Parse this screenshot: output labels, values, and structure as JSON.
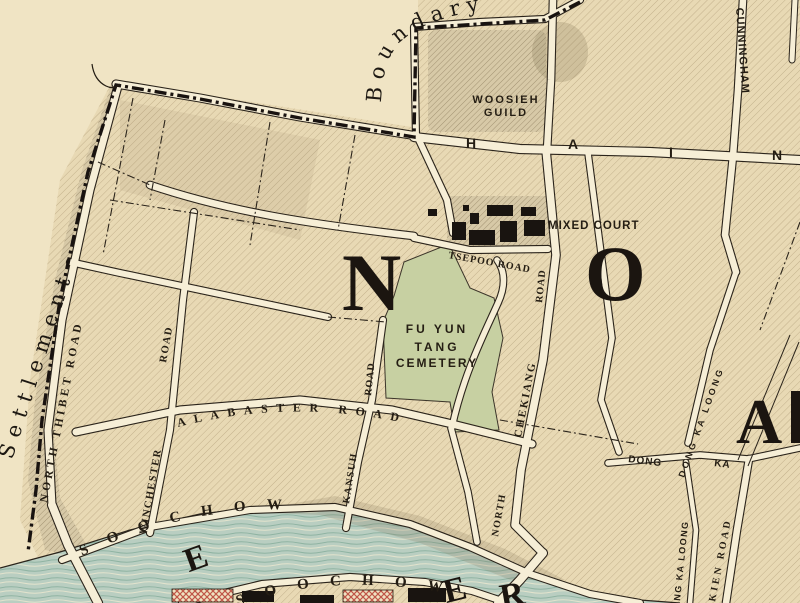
{
  "map_type": "historic-city-map",
  "colors": {
    "paper": "#f0e4c4",
    "land": "#e8d9b4",
    "road": "#f6eed6",
    "ink": "#241d13",
    "boundary": "#191310",
    "creek": "#b9cec1",
    "creek_wave": "#8fb3a2",
    "cemetery_green": "#c7d0a2",
    "building_black": "#191410",
    "building_red": "#c05648",
    "block_shaded": "#d7c9a7"
  },
  "region": {
    "settlement_label": "Settlement",
    "boundary_label": "Boundary",
    "big_letters": [
      "N",
      "O"
    ],
    "big_letter_partial": "A",
    "creek_big_letters": [
      "E",
      "E",
      "R"
    ]
  },
  "places": {
    "woosieh_guild_line1": "WOOSIEH",
    "woosieh_guild_line2": "GUILD",
    "mixed_court": "MIXED COURT",
    "cemetery_line1": "FU YUN",
    "cemetery_line2": "TANG",
    "cemetery_line3": "CEMETERY"
  },
  "roads": {
    "haining_letters": [
      "H",
      "A",
      "I",
      "N"
    ],
    "cunningham": "CUNNINGHAM",
    "north_thibet": "NORTH THIBET ROAD",
    "winchester": "WINCHESTER",
    "road_word": "ROAD",
    "alabaster": "ALABASTER ROAD",
    "kansuh": "KANSUH",
    "north_word": "NORTH",
    "chekiang": "CHEKIANG",
    "tsepoo": "TSEPOO ROAD",
    "soochow": "SOOCHOW",
    "dong_ka_loong": "DONG KA LOONG",
    "dong": "DONG",
    "ka": "KA",
    "ng_ka_loong": "NG KA LOONG",
    "kien_road": "KIEN ROAD"
  }
}
